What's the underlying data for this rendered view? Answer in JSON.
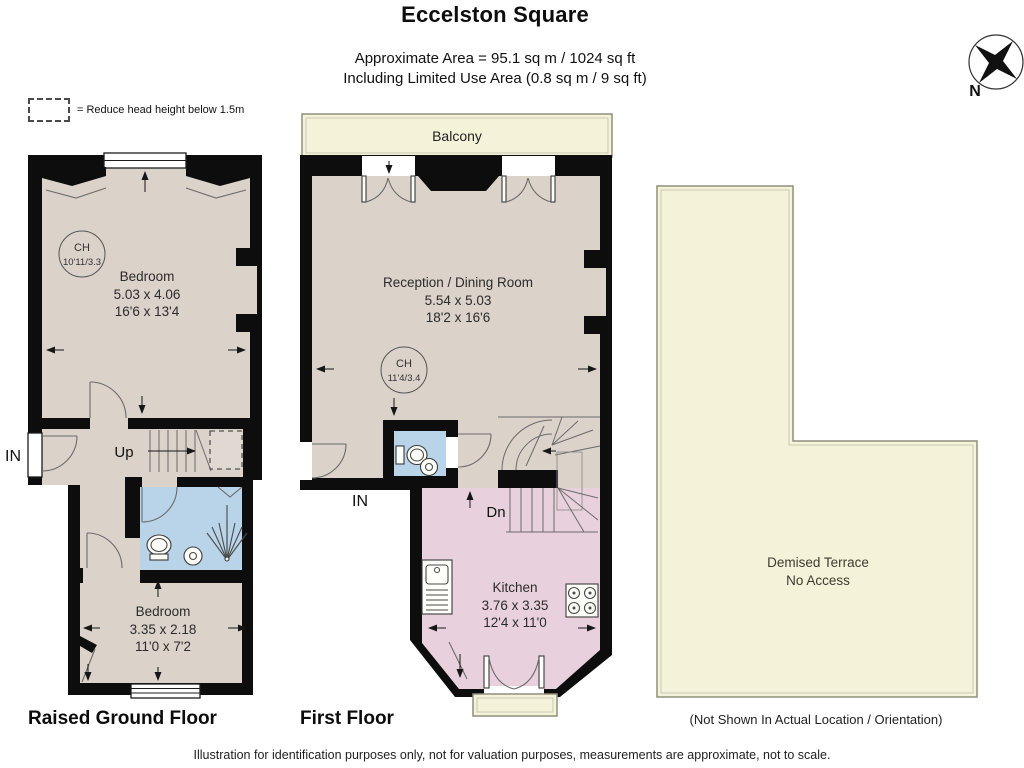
{
  "header": {
    "title": "Eccelston Square",
    "area_line1": "Approximate Area = 95.1 sq m / 1024 sq ft",
    "area_line2": "Including Limited Use Area (0.8 sq m / 9 sq ft)"
  },
  "legend": {
    "label": "= Reduce head height below 1.5m"
  },
  "compass": {
    "north": "N"
  },
  "colors": {
    "wall": "#0d0d0d",
    "room": "#dbd2ca",
    "bathroom": "#b9d4e9",
    "kitchen": "#e8d1dd",
    "outdoor": "#f4f2d8",
    "outdoor_border": "#8f8f7c"
  },
  "ground_floor": {
    "label": "Raised Ground Floor",
    "entrance": "IN",
    "stairs": "Up",
    "ch": {
      "title": "CH",
      "value": "10'11/3.3"
    },
    "bedroom1": {
      "name": "Bedroom",
      "metric": "5.03 x 4.06",
      "imperial": "16'6 x 13'4"
    },
    "bedroom2": {
      "name": "Bedroom",
      "metric": "3.35 x 2.18",
      "imperial": "11'0 x 7'2"
    }
  },
  "first_floor": {
    "label": "First Floor",
    "entrance": "IN",
    "stairs": "Dn",
    "balcony": "Balcony",
    "ch": {
      "title": "CH",
      "value": "11'4/3.4"
    },
    "reception": {
      "name": "Reception / Dining Room",
      "metric": "5.54 x 5.03",
      "imperial": "18'2 x 16'6"
    },
    "kitchen": {
      "name": "Kitchen",
      "metric": "3.76 x 3.35",
      "imperial": "12'4 x 11'0"
    }
  },
  "terrace": {
    "name": "Demised Terrace",
    "access": "No Access",
    "note": "(Not Shown In Actual Location / Orientation)"
  },
  "footer": {
    "disclaimer": "Illustration for identification purposes only, not for valuation purposes, measurements are approximate, not to scale."
  }
}
